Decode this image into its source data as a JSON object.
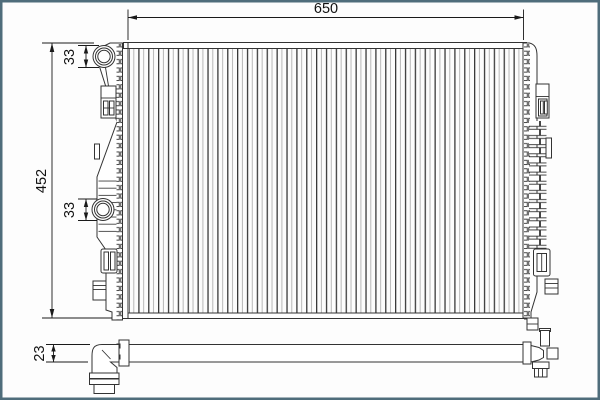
{
  "frame": {
    "border_color": "#4f6d7b",
    "background_color": "#fdfdfd"
  },
  "drawing": {
    "type": "technical-drawing",
    "subject": "radiator",
    "line_color": "#333333",
    "dimension_color": "#1a1a1a",
    "dimensions": {
      "overall_width": "650",
      "overall_height": "452",
      "top_port_diameter": "33",
      "mid_port_diameter": "33",
      "side_view_thickness": "23"
    }
  }
}
